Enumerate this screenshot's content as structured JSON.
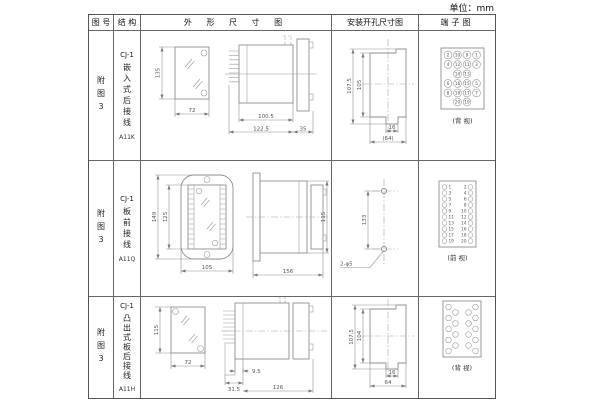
{
  "unit_label": "单位：mm",
  "headers": {
    "fig_no": "图 号",
    "structure": "结 构",
    "outline": "外 形 尺 寸 图",
    "install": "安装开孔尺寸图",
    "terminal": "端子图"
  },
  "rows": [
    {
      "fig_no": "附图3",
      "model": "CJ-1",
      "mount_type": "嵌入式后接线",
      "code": "A11K",
      "outline_dims": {
        "front_h": "135",
        "front_w": "72",
        "side_len": "100.5",
        "side_total": "122.5",
        "side_flange": "35"
      },
      "install_dims": {
        "outer_h": "107.5",
        "inner_h": "105",
        "slot_w": "16",
        "width": "(64)"
      },
      "terminal": {
        "caption": "(背 视)",
        "grid": [
          [
            "2",
            "10",
            "9",
            "1"
          ],
          [
            "4",
            "12",
            "11",
            "3"
          ],
          [
            "",
            "14",
            "13",
            ""
          ],
          [
            "6",
            "16",
            "15",
            "5"
          ],
          [
            "8",
            "18",
            "17",
            "7"
          ],
          [
            "",
            "20",
            "19",
            ""
          ]
        ]
      }
    },
    {
      "fig_no": "附图3",
      "model": "CJ-1",
      "mount_type": "板前接线",
      "code": "A11Q",
      "outline_dims": {
        "front_h": "149",
        "inner_h": "125",
        "front_w": "105",
        "side_len": "156",
        "side_h": "115"
      },
      "install_dims": {
        "hole_dist": "133",
        "holes_label": "2-φ5"
      },
      "terminal": {
        "caption": "(前 视)",
        "left": [
          "1",
          "3",
          "5",
          "7",
          "9",
          "11",
          "13",
          "15",
          "17",
          "19"
        ],
        "right": [
          "2",
          "4",
          "6",
          "8",
          "10",
          "12",
          "14",
          "16",
          "18",
          "20"
        ]
      }
    },
    {
      "fig_no": "附图3",
      "model": "CJ-1",
      "mount_type": "凸出式板后接线",
      "code": "A11H",
      "outline_dims": {
        "front_h": "115",
        "front_w": "72",
        "side_a": "31.5",
        "side_b": "9.5",
        "side_len": "126"
      },
      "install_dims": {
        "outer_h": "107.5",
        "inner_h": "104",
        "slot_w": "16",
        "width": "64"
      },
      "terminal": {
        "caption": "(背 视)"
      }
    }
  ]
}
